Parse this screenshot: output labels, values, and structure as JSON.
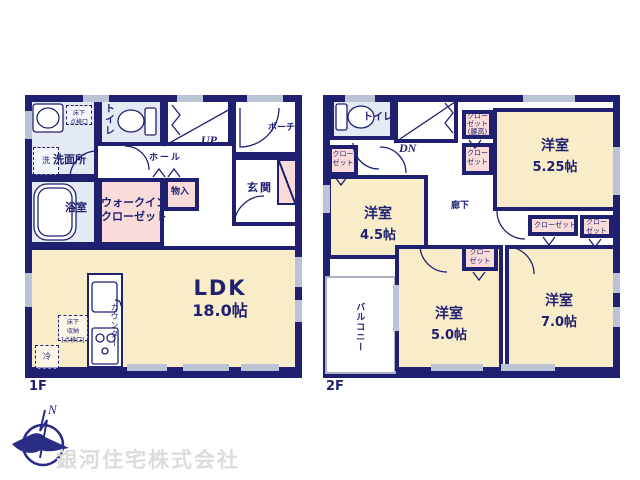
{
  "floor1": {
    "label": "1F",
    "ldk": {
      "name": "LDK",
      "size": "18.0帖"
    },
    "washroom": "洗面所",
    "bath": "浴室",
    "toilet": "トイレ",
    "wic": {
      "line1": "ウォークイン",
      "line2": "クローゼット"
    },
    "storage": "物入",
    "hall": "ホール",
    "entrance": "玄関",
    "porch": "ポーチ",
    "stairs": "UP",
    "counter": "カウンター",
    "fridge": "冷",
    "washer": "洗",
    "underfloor_access": {
      "line1": "床下",
      "line2": "点検口"
    },
    "underfloor_storage": {
      "line1": "床下",
      "line2": "収納",
      "line3": "[点検口]"
    }
  },
  "floor2": {
    "label": "2F",
    "toilet": "トイレ",
    "stairs": "DN",
    "corridor": "廊下",
    "balcony": "バルコニー",
    "rooms": {
      "r45": {
        "name": "洋室",
        "size": "4.5帖"
      },
      "r525": {
        "name": "洋室",
        "size": "5.25帖"
      },
      "r50": {
        "name": "洋室",
        "size": "5.0帖"
      },
      "r70": {
        "name": "洋室",
        "size": "7.0帖"
      }
    },
    "closets": {
      "full": "クローゼット",
      "line1": "クロー",
      "line2": "ゼット",
      "koshidaka": "(腰高)"
    }
  },
  "footer": {
    "company": "銀河住宅株式会社",
    "compass_n": "N"
  },
  "colors": {
    "wall": "#1f2170",
    "room_cream": "#f9ecc9",
    "closet_pink": "#f9dcda",
    "wet_blue": "#e3eaf4",
    "window_gray": "#bdc3d6"
  }
}
